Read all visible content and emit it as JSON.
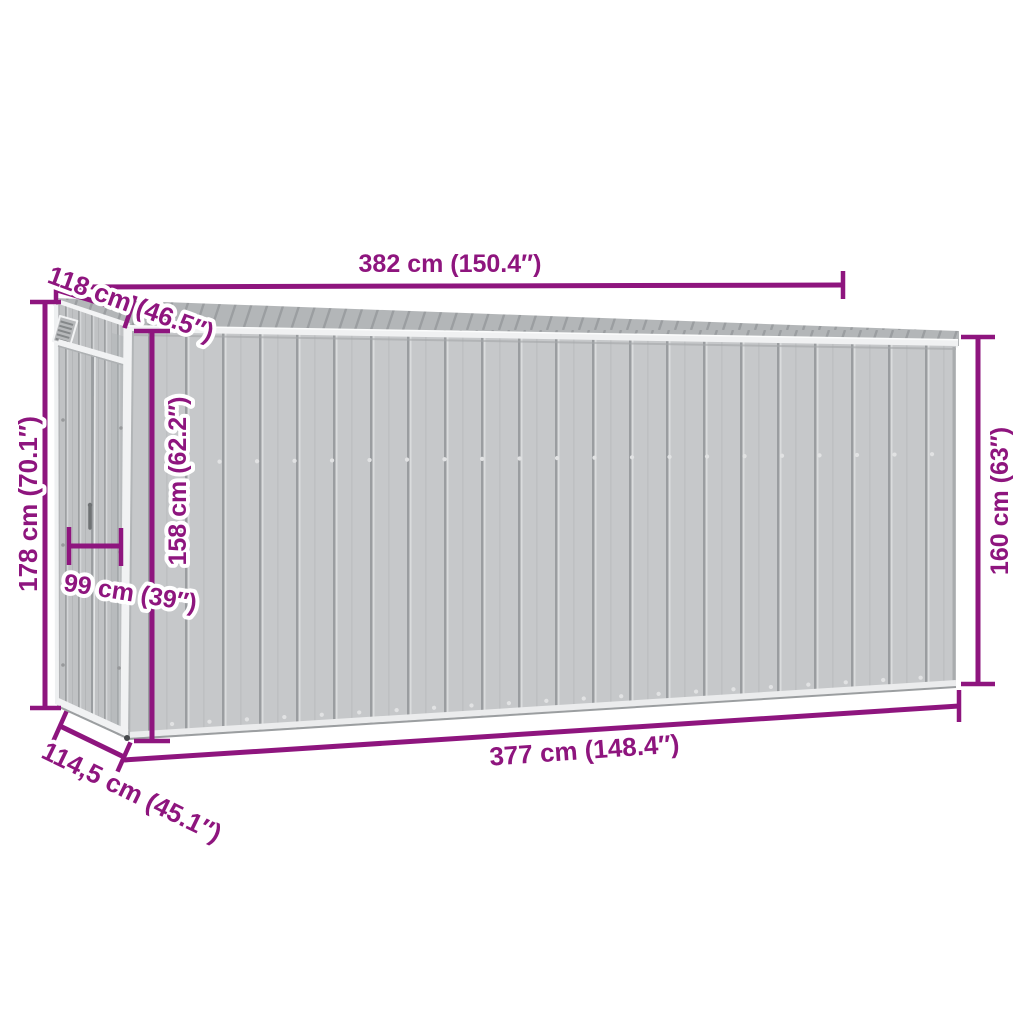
{
  "diagram": {
    "background_color": "#FFFFFF",
    "accent_color": "#8E157E",
    "shed_colors": {
      "wall": "#C6C8CA",
      "roof": "#B3B6B8",
      "trim": "#F1F2F3",
      "groove": "#9A9DA0"
    },
    "dimensions": {
      "roof_length": "382 cm (150.4″)",
      "roof_depth": "118 cm (46.5″)",
      "rear_height": "178 cm (70.1″)",
      "eave_height": "158 cm (62.2″)",
      "door_width": "99 cm (39″)",
      "floor_depth": "114,5 cm (45.1″)",
      "floor_length": "377 cm (148.4″)",
      "front_height": "160 cm (63″)"
    }
  }
}
